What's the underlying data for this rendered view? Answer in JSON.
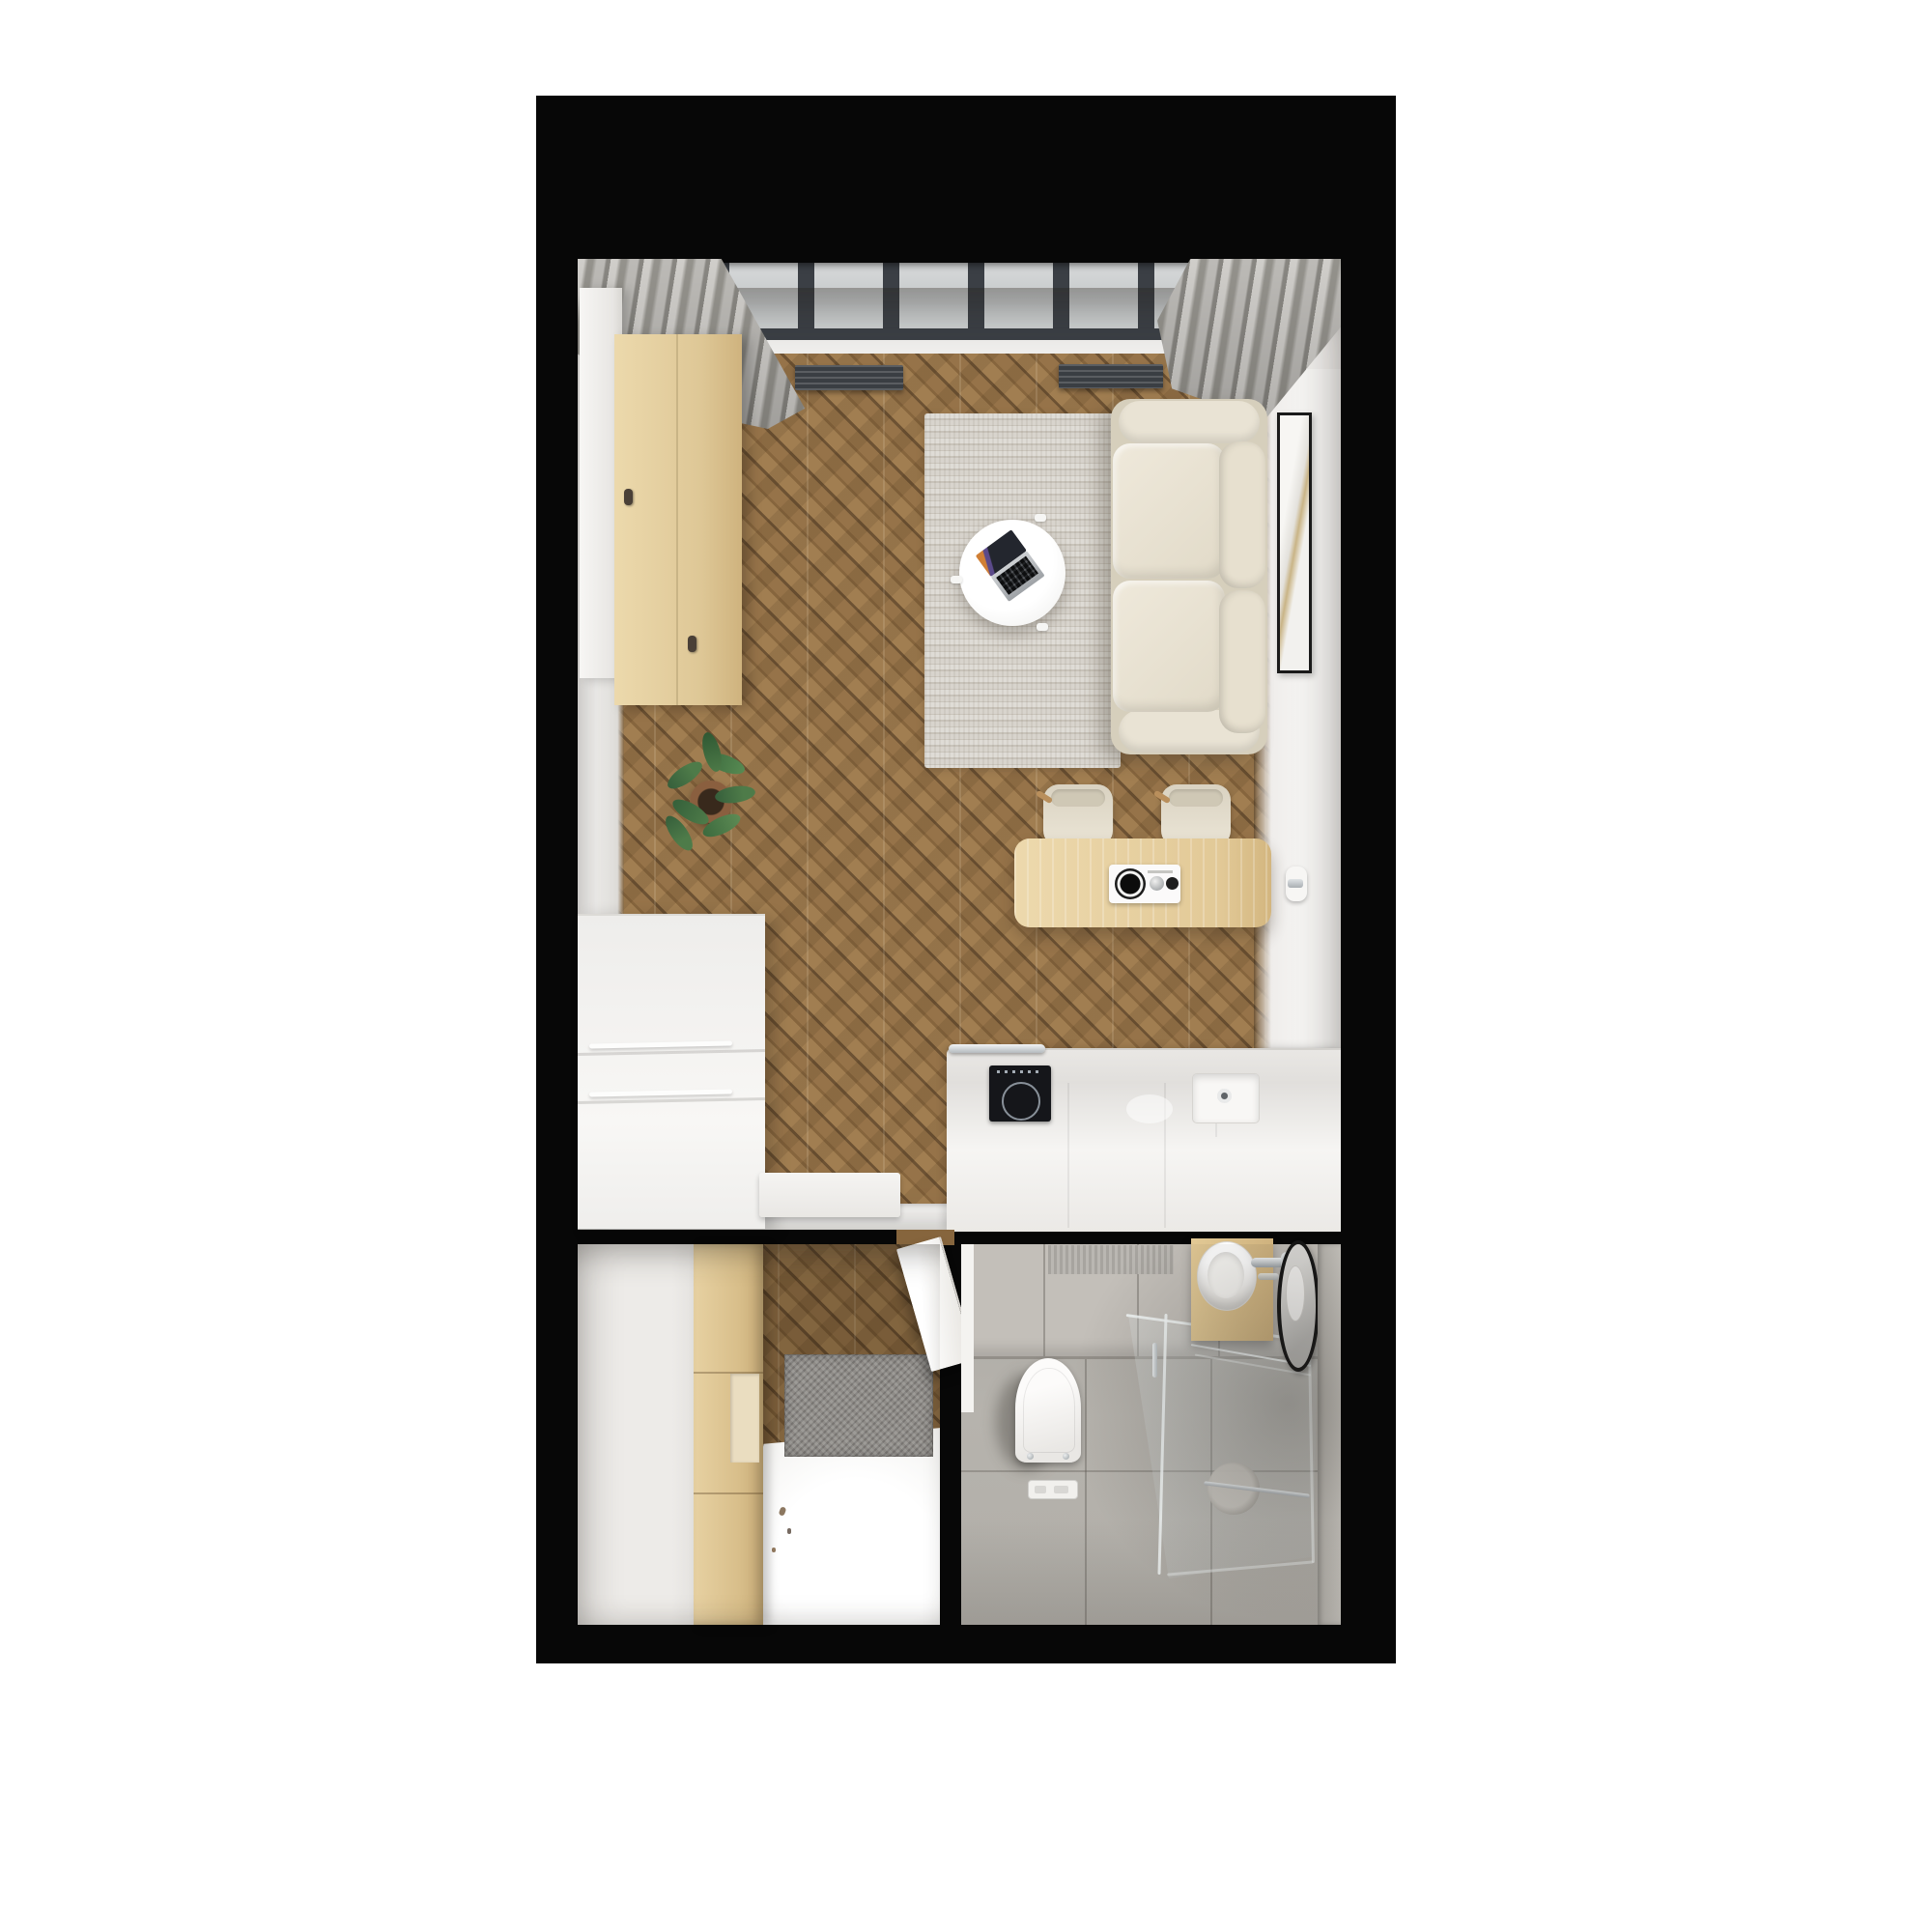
{
  "meta": {
    "title": "Studio apartment floor plan — top-down 3D render"
  },
  "palette": {
    "outside": "#ffffff",
    "black": "#070707",
    "wood_light": "#a17e51",
    "wood_mid": "#967349",
    "wood_dark": "#86653d",
    "wood_seam": "#6d5233",
    "wall": "#efedeb",
    "wall_dark": "#dedcd8",
    "white_soft": "#f5f4f2",
    "sofa": "#e9e3d4",
    "sofa_dark": "#d6cfbc",
    "rug_a": "#dfdcd6",
    "rug_b": "#c8c3ba",
    "curtain_a": "#d4d2ce",
    "curtain_b": "#97958f",
    "glass_a": "#d8dadb",
    "glass_b": "#c4c7c8",
    "frame_dark": "#3b3f45",
    "radiator": "#3a3e43",
    "tile_floor": "#b1aea8",
    "tile_wall": "#c3bfb9",
    "chrome": "#dfe3e5",
    "chrome_dark": "#a9aeb2",
    "plant_a": "#4e7b49",
    "plant_b": "#365f3b",
    "pot": "#8a5f3f",
    "soil": "#38291c",
    "mirror_rim": "#141414",
    "hob": "#15161a"
  },
  "objects": {
    "floor_plan": "Apartment floor plan render",
    "living_room": "Living room with kitchen",
    "window_wall": "Window wall with grey frames",
    "curtain_left": "Grey curtain (left corner)",
    "curtain_right": "Grey curtain (right corner)",
    "radiator": "Floor radiator grille",
    "rug": "Striped grey area rug",
    "coffee_table": "Round white coffee table",
    "laptop": "Open laptop",
    "sofa": "Cream two-seat sofa",
    "picture": "Framed wall art",
    "door_handle": "Concealed door handle",
    "chair": "Cream dining chair",
    "dining_table": "Light oak dining table",
    "appliance": "Tabletop appliance with knobs",
    "wardrobe": "Tall white wardrobe",
    "sideboard": "Oak sideboard",
    "plant": "Potted green plant",
    "dresser": "White drawer dresser",
    "threshold_mat": "White threshold mat",
    "kitchen_counter": "White kitchen counter",
    "hob": "Induction hob",
    "rail": "Chrome rail",
    "sink": "Kitchen sink with drain",
    "hallway": "Entry hall",
    "hall_wardrobe": "Oak hall wardrobe",
    "hall_doormat": "Grey doormat",
    "hall_floor": "Bright entry floor",
    "entry_door": "Open entry door leaf",
    "bathroom": "Bathroom",
    "toilet": "Wall-hung toilet",
    "flush_plate": "Floor drain plate",
    "shower": "Glass shower enclosure",
    "paper_roll": "Paper roll holder",
    "towel_bar": "Glass-mounted towel bar",
    "vanity": "Oak bathroom vanity",
    "vanity_sink": "Oval washbasin",
    "faucet": "Chrome basin faucet",
    "mirror": "Round black-rim mirror"
  }
}
